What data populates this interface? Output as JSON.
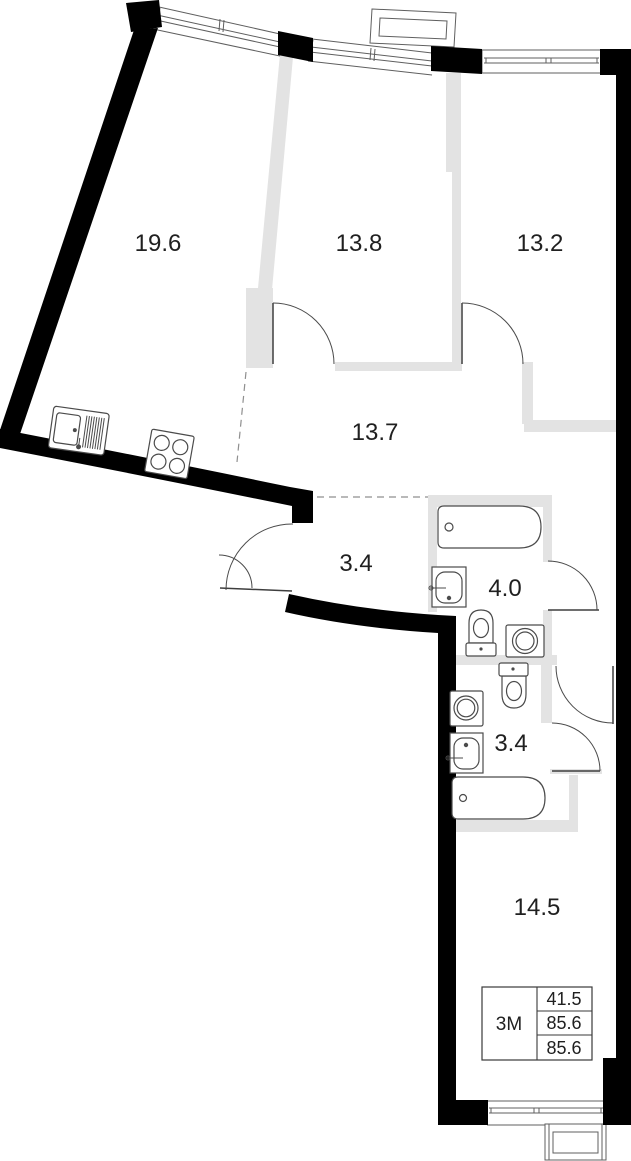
{
  "plan": {
    "rooms": [
      {
        "id": "kitchen-living",
        "area": "19.6"
      },
      {
        "id": "bedroom-1",
        "area": "13.8"
      },
      {
        "id": "bedroom-2",
        "area": "13.2"
      },
      {
        "id": "corridor",
        "area": "13.7"
      },
      {
        "id": "hallway",
        "area": "3.4"
      },
      {
        "id": "bathroom",
        "area": "4.0"
      },
      {
        "id": "wc",
        "area": "3.4"
      },
      {
        "id": "bedroom-3",
        "area": "14.5"
      }
    ],
    "summary_table": {
      "type_label": "3М",
      "rows": [
        "41.5",
        "85.6",
        "85.6"
      ]
    },
    "colors": {
      "wall": "#000000",
      "partition": "#e3e3e3",
      "outline": "#4b4b4b",
      "label": "#202020",
      "background": "#ffffff"
    }
  }
}
